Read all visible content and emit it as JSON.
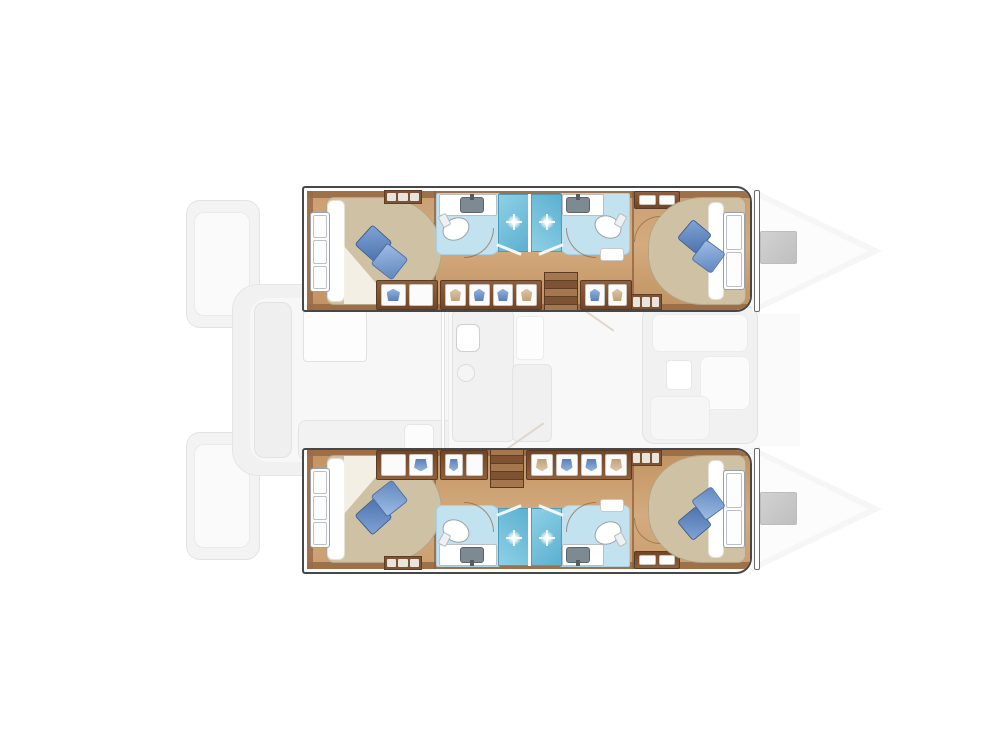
{
  "canvas": {
    "w": 1007,
    "h": 755,
    "bg": "#ffffff"
  },
  "palette": {
    "wood_floor": "#c99f72",
    "wood_dark_trim": "#9a6b45",
    "cabinet_brown": "#7c5335",
    "bed_beige": "#cfc1a3",
    "pillow_blue_dark": "#4f74ad",
    "pillow_blue_light": "#9dbce4",
    "bathroom_floor_blue": "#c2e2f0",
    "shower_blue": "#5cb0d1",
    "fixture_white": "#ffffff",
    "sink_gray": "#7e8a91",
    "faded_deck_gray": "#f1f1f1",
    "bow_hatch_gray": "#cacaca",
    "hull_outline": "#474747"
  },
  "hull_geometry": {
    "x": 302,
    "w": 450,
    "h": 126
  },
  "underlay": [
    {
      "name": "stern-platform-port",
      "x": 186,
      "y": 200,
      "w": 74,
      "h": 128,
      "bg": "#f3f3f3",
      "bd": "#e3e3e3",
      "r": "14px"
    },
    {
      "name": "stern-platform-port-step",
      "x": 194,
      "y": 212,
      "w": 56,
      "h": 104,
      "bg": "#fafafa",
      "bd": "#eaeaea",
      "r": "10px"
    },
    {
      "name": "stern-platform-starboard",
      "x": 186,
      "y": 432,
      "w": 74,
      "h": 128,
      "bg": "#f3f3f3",
      "bd": "#e3e3e3",
      "r": "14px"
    },
    {
      "name": "stern-platform-starboard-step",
      "x": 194,
      "y": 444,
      "w": 56,
      "h": 104,
      "bg": "#fafafa",
      "bd": "#eaeaea",
      "r": "10px"
    },
    {
      "name": "transom-steps-upper",
      "x": 250,
      "y": 332,
      "w": 24,
      "h": 22,
      "bg": "#f0f0f0",
      "bd": "#e4e4e4",
      "r": "4px"
    },
    {
      "name": "transom-steps-lower",
      "x": 250,
      "y": 404,
      "w": 24,
      "h": 22,
      "bg": "#f0f0f0",
      "bd": "#e4e4e4",
      "r": "4px"
    },
    {
      "name": "aft-cockpit-deck",
      "x": 232,
      "y": 284,
      "w": 244,
      "h": 192,
      "bg": "#f1f1f1",
      "bd": "#e5e5e5",
      "r": "26px"
    },
    {
      "name": "aft-cockpit-floor",
      "x": 250,
      "y": 298,
      "w": 212,
      "h": 164,
      "bg": "#f7f7f7",
      "r": "18px"
    },
    {
      "name": "cockpit-bench-left",
      "x": 254,
      "y": 302,
      "w": 38,
      "h": 156,
      "bg": "#efefef",
      "bd": "#e2e2e2",
      "r": "10px"
    },
    {
      "name": "cockpit-table",
      "x": 303,
      "y": 310,
      "w": 64,
      "h": 52,
      "bg": "#fdfdfd",
      "bd": "#e1e1e1",
      "r": "4px"
    },
    {
      "name": "cockpit-aft-seat",
      "x": 298,
      "y": 420,
      "w": 164,
      "h": 40,
      "bg": "#f2f2f2",
      "bd": "#e4e4e4",
      "r": "8px"
    },
    {
      "name": "cockpit-side-seat",
      "x": 404,
      "y": 424,
      "w": 30,
      "h": 32,
      "bg": "#fcfcfc",
      "bd": "#e6e6e6",
      "r": "6px"
    },
    {
      "name": "salon-deck",
      "x": 448,
      "y": 306,
      "w": 312,
      "h": 148,
      "bg": "#f8f8f8",
      "bd": "#ececec",
      "r": "8px"
    },
    {
      "name": "foredeck",
      "x": 754,
      "y": 314,
      "w": 46,
      "h": 132,
      "bg": "#fafafa"
    },
    {
      "name": "salon-door-track",
      "x": 441,
      "y": 304,
      "w": 4,
      "h": 152,
      "bg": "#ffffff",
      "bd": "#e0e0e0"
    },
    {
      "name": "galley-counter",
      "x": 452,
      "y": 310,
      "w": 62,
      "h": 132,
      "bg": "#f1f1f1",
      "bd": "#e3e3e3",
      "r": "6px"
    },
    {
      "name": "galley-appliance",
      "x": 456,
      "y": 324,
      "w": 24,
      "h": 28,
      "bg": "#ffffff",
      "bd": "#cfcfcf",
      "r": "6px"
    },
    {
      "name": "galley-sink-circle",
      "t": "ellipse",
      "x": 457,
      "y": 364,
      "w": 18,
      "h": 18,
      "bg": "#f5f5f5",
      "bd": "#dcdcdc"
    },
    {
      "name": "salon-island-top",
      "x": 516,
      "y": 316,
      "w": 28,
      "h": 44,
      "bg": "#fdfdfd",
      "bd": "#ececec",
      "r": "4px"
    },
    {
      "name": "salon-island",
      "x": 512,
      "y": 364,
      "w": 40,
      "h": 78,
      "bg": "#f0f0f0",
      "bd": "#e3e3e3",
      "r": "6px"
    },
    {
      "name": "hull-stair-rail-port",
      "x": 570,
      "y": 316,
      "w": 48,
      "h": 2,
      "bg": "#ded3c8",
      "rot": 35,
      "op": 0.9
    },
    {
      "name": "hull-stair-rail-starboard",
      "x": 500,
      "y": 436,
      "w": 48,
      "h": 2,
      "bg": "#ded3c8",
      "rot": -35,
      "op": 0.9
    },
    {
      "name": "salon-sofa-base",
      "x": 642,
      "y": 306,
      "w": 116,
      "h": 138,
      "bg": "#f1f1f1",
      "bd": "#e2e2e2",
      "r": "12px"
    },
    {
      "name": "salon-sofa-seat-fwd",
      "x": 652,
      "y": 314,
      "w": 96,
      "h": 38,
      "bg": "#fafafa",
      "bd": "#ececec",
      "r": "8px"
    },
    {
      "name": "salon-sofa-chaise",
      "x": 700,
      "y": 356,
      "w": 50,
      "h": 54,
      "bg": "#fbfbfb",
      "bd": "#ececec",
      "r": "8px"
    },
    {
      "name": "salon-sofa-seat-aft",
      "x": 650,
      "y": 396,
      "w": 60,
      "h": 44,
      "bg": "#f6f6f6",
      "bd": "#ececec",
      "r": "8px"
    },
    {
      "name": "salon-coffee-table",
      "x": 666,
      "y": 360,
      "w": 26,
      "h": 30,
      "bg": "#ffffff",
      "bd": "#e6e6e6",
      "r": "4px"
    },
    {
      "name": "bow-deck-port",
      "t": "tri",
      "x": 752,
      "y": 188,
      "w": 130,
      "h": 126,
      "bg": "#f6f6f6",
      "clip": "polygon(0 0,100% 50%,0 100%)"
    },
    {
      "name": "bow-deck-port-inner",
      "t": "tri",
      "x": 756,
      "y": 196,
      "w": 112,
      "h": 110,
      "bg": "#fcfcfc",
      "clip": "polygon(0 0,100% 50%,0 100%)"
    },
    {
      "name": "bow-hatch-port",
      "x": 760,
      "y": 231,
      "w": 37,
      "h": 33,
      "bg": "linear-gradient(135deg,#d2d2d2,#bfbfbf)",
      "bd": "#bdbdbd",
      "r": "2px"
    },
    {
      "name": "bow-deck-starboard",
      "t": "tri",
      "x": 752,
      "y": 446,
      "w": 130,
      "h": 126,
      "bg": "#f6f6f6",
      "clip": "polygon(0 0,100% 50%,0 100%)"
    },
    {
      "name": "bow-deck-starboard-inner",
      "t": "tri",
      "x": 756,
      "y": 454,
      "w": 112,
      "h": 110,
      "bg": "#fcfcfc",
      "clip": "polygon(0 0,100% 50%,0 100%)"
    },
    {
      "name": "bow-hatch-starboard",
      "x": 760,
      "y": 492,
      "w": 37,
      "h": 33,
      "bg": "linear-gradient(135deg,#d2d2d2,#bfbfbf)",
      "bd": "#bdbdbd",
      "r": "2px"
    }
  ],
  "hull_items": [
    {
      "name": "cabin-sole",
      "x": 3,
      "y": 3,
      "w": 444,
      "h": 120,
      "bg": "linear-gradient(180deg,#c99f72,#d4ab7e 45%,#c09160)",
      "r": "2px 12px 12px 2px"
    },
    {
      "name": "joinery-trim-top",
      "x": 3,
      "y": 3,
      "w": 444,
      "h": 7,
      "bg": "#9a6b45",
      "op": 0.9
    },
    {
      "name": "joinery-trim-bottom",
      "x": 3,
      "y": 116,
      "w": 444,
      "h": 7,
      "bg": "#9a6b45",
      "op": 0.9
    },
    {
      "name": "aft-bulkhead-trim",
      "x": 3,
      "y": 3,
      "w": 6,
      "h": 120,
      "bg": "#9a6b45",
      "op": 0.85
    },
    {
      "name": "bulkhead-aft-bathroom",
      "x": 130,
      "y": 3,
      "w": 2,
      "h": 120,
      "bg": "#8a5c3a",
      "op": 0.7
    },
    {
      "name": "bulkhead-fwd-cabin",
      "x": 328,
      "y": 3,
      "w": 2,
      "h": 120,
      "bg": "#8a5c3a",
      "op": 0.7
    },
    {
      "name": "aft-cabin-bed",
      "x": 22,
      "y": 9,
      "w": 116,
      "h": 108,
      "bg": "#cfc1a3",
      "bd": "#b4a485",
      "r": "8px 58px 58px 8px / 8px 54px 54px 8px"
    },
    {
      "name": "aft-bed-sheet",
      "x": 23,
      "y": 12,
      "w": 18,
      "h": 102,
      "bg": "#ffffff",
      "bd": "#e4e0d6",
      "r": "6px"
    },
    {
      "name": "aft-bed-sheet-fold",
      "t": "tri",
      "x": 40,
      "y": 58,
      "w": 50,
      "h": 58,
      "bg": "#f4f1e8",
      "clip": "polygon(0 0,100% 100%,0 100%)",
      "op": 0.95
    },
    {
      "name": "aft-berth-window",
      "t": "panes",
      "x": 6,
      "y": 24,
      "w": 20,
      "h": 80,
      "panes": 3
    },
    {
      "name": "aft-pillow-1",
      "x": 56,
      "y": 42,
      "w": 27,
      "h": 27,
      "bg": "linear-gradient(135deg,#7fa3d6,#4f74ad)",
      "bd": "#3d5f95",
      "r": "3px",
      "rot": 42
    },
    {
      "name": "aft-pillow-2",
      "x": 72,
      "y": 60,
      "w": 27,
      "h": 27,
      "bg": "linear-gradient(135deg,#9dbce4,#6288c0)",
      "bd": "#4d6fa5",
      "r": "3px",
      "rot": 38
    },
    {
      "name": "aft-locker-louver",
      "t": "louver",
      "x": 80,
      "y": 2,
      "w": 38,
      "h": 14,
      "bars": 3
    },
    {
      "name": "bathroom-floor-aft",
      "x": 132,
      "y": 5,
      "w": 64,
      "h": 62,
      "bg": "#c2e2f0",
      "bd": "#a8cfe2",
      "r": "2px 2px 10px 6px"
    },
    {
      "name": "bathroom-floor-fwd",
      "x": 256,
      "y": 5,
      "w": 70,
      "h": 62,
      "bg": "#c2e2f0",
      "bd": "#a8cfe2",
      "r": "2px 2px 6px 10px"
    },
    {
      "name": "shower-stall-aft",
      "x": 194,
      "y": 6,
      "w": 31,
      "h": 58,
      "bg": "linear-gradient(135deg,#8ed0e6,#5cb0d1)",
      "bd": "#4d9bba"
    },
    {
      "name": "shower-stall-fwd",
      "x": 227,
      "y": 6,
      "w": 31,
      "h": 58,
      "bg": "linear-gradient(45deg,#8ed0e6,#5cb0d1)",
      "bd": "#4d9bba"
    },
    {
      "name": "shower-divider-wall",
      "x": 224,
      "y": 6,
      "w": 3,
      "h": 58,
      "bg": "#ffffff"
    },
    {
      "name": "shower-head-sparkle-aft",
      "t": "sparkle",
      "x": 202,
      "y": 26,
      "w": 16,
      "h": 16
    },
    {
      "name": "shower-head-sparkle-fwd",
      "t": "sparkle",
      "x": 235,
      "y": 26,
      "w": 16,
      "h": 16
    },
    {
      "name": "vanity-counter-aft",
      "x": 135,
      "y": 6,
      "w": 58,
      "h": 22,
      "bg": "#ffffff",
      "bd": "#b9bfc3",
      "r": "2px"
    },
    {
      "name": "sink-basin-aft",
      "x": 156,
      "y": 9,
      "w": 24,
      "h": 16,
      "bg": "#7e8a91",
      "bd": "#5c656b",
      "r": "3px"
    },
    {
      "name": "faucet-aft",
      "x": 166,
      "y": 6,
      "w": 4,
      "h": 6,
      "bg": "#555b5f"
    },
    {
      "name": "toilet-aft",
      "t": "ellipse",
      "x": 138,
      "y": 30,
      "w": 28,
      "h": 22,
      "bg": "#ffffff",
      "bd": "#9aa2a8",
      "rot": -28
    },
    {
      "name": "toilet-aft-tank",
      "x": 136,
      "y": 26,
      "w": 9,
      "h": 13,
      "bg": "#eef0f1",
      "bd": "#b6bcc0",
      "r": "2px",
      "rot": -28
    },
    {
      "name": "vanity-counter-fwd",
      "x": 258,
      "y": 6,
      "w": 42,
      "h": 22,
      "bg": "#ffffff",
      "bd": "#b9bfc3",
      "r": "2px"
    },
    {
      "name": "sink-basin-fwd",
      "x": 262,
      "y": 9,
      "w": 24,
      "h": 16,
      "bg": "#7e8a91",
      "bd": "#5c656b",
      "r": "3px"
    },
    {
      "name": "faucet-fwd",
      "x": 272,
      "y": 6,
      "w": 4,
      "h": 6,
      "bg": "#555b5f"
    },
    {
      "name": "toilet-fwd",
      "t": "ellipse",
      "x": 290,
      "y": 28,
      "w": 28,
      "h": 22,
      "bg": "#ffffff",
      "bd": "#9aa2a8",
      "rot": 28
    },
    {
      "name": "toilet-fwd-tank",
      "x": 312,
      "y": 26,
      "w": 9,
      "h": 13,
      "bg": "#eef0f1",
      "bd": "#b6bcc0",
      "r": "2px",
      "rot": 28
    },
    {
      "name": "door-swing-aft-bathroom",
      "t": "arc",
      "x": 160,
      "y": 40,
      "w": 30,
      "h": 30,
      "bd": "#8a5c3a",
      "dir": "br",
      "op": 0.65
    },
    {
      "name": "door-swing-fwd-bathroom",
      "t": "arc",
      "x": 262,
      "y": 40,
      "w": 30,
      "h": 30,
      "bd": "#8a5c3a",
      "dir": "bl",
      "op": 0.65
    },
    {
      "name": "shower-door-aft",
      "x": 192,
      "y": 60,
      "w": 26,
      "h": 3,
      "bg": "#ffffff",
      "rot": 22,
      "op": 0.9
    },
    {
      "name": "shower-door-fwd",
      "x": 234,
      "y": 60,
      "w": 26,
      "h": 3,
      "bg": "#ffffff",
      "rot": -22,
      "op": 0.9
    },
    {
      "name": "bathroom-cabinet-fwd",
      "x": 296,
      "y": 60,
      "w": 24,
      "h": 13,
      "bg": "#ffffff",
      "bd": "#c9c9c9",
      "r": "3px"
    },
    {
      "name": "fwd-wardrobe",
      "t": "cabinet",
      "x": 330,
      "y": 3,
      "w": 46,
      "h": 18,
      "glyphs": [
        "none",
        "none"
      ]
    },
    {
      "name": "fwd-cabin-bed",
      "x": 344,
      "y": 9,
      "w": 98,
      "h": 108,
      "bg": "#cfc1a3",
      "bd": "#b4a485",
      "r": "54px 8px 8px 54px / 50px 8px 8px 50px"
    },
    {
      "name": "fwd-bed-sheet",
      "x": 404,
      "y": 14,
      "w": 16,
      "h": 98,
      "bg": "#ffffff",
      "bd": "#e4e0d6",
      "r": "6px"
    },
    {
      "name": "fwd-berth-window",
      "t": "panes",
      "x": 419,
      "y": 24,
      "w": 22,
      "h": 78,
      "panes": 2
    },
    {
      "name": "fwd-pillow-1",
      "x": 378,
      "y": 36,
      "w": 25,
      "h": 25,
      "bg": "linear-gradient(135deg,#7fa3d6,#4f74ad)",
      "bd": "#3d5f95",
      "r": "3px",
      "rot": 40
    },
    {
      "name": "fwd-pillow-2",
      "x": 392,
      "y": 56,
      "w": 25,
      "h": 25,
      "bg": "linear-gradient(135deg,#9dbce4,#6288c0)",
      "bd": "#4d6fa5",
      "r": "3px",
      "rot": 36
    },
    {
      "name": "fwd-locker-louver",
      "t": "louver",
      "x": 326,
      "y": 106,
      "w": 32,
      "h": 16,
      "bars": 3
    },
    {
      "name": "fwd-cabin-door-swing",
      "t": "arc",
      "x": 330,
      "y": 28,
      "w": 26,
      "h": 26,
      "bd": "#8a5c3a",
      "dir": "tl",
      "op": 0.6
    }
  ],
  "hulls": [
    {
      "name": "port-hull",
      "y": 186,
      "flip": false,
      "extras": [
        {
          "name": "wardrobe-a",
          "t": "cabinet",
          "x": 72,
          "y": 92,
          "w": 62,
          "h": 30,
          "glyphs": [
            "blue",
            "none"
          ]
        },
        {
          "name": "wardrobe-b",
          "t": "cabinet",
          "x": 136,
          "y": 92,
          "w": 102,
          "h": 30,
          "glyphs": [
            "tan",
            "blue",
            "blue",
            "tan"
          ]
        },
        {
          "name": "companionway-stairs",
          "t": "stairs",
          "x": 240,
          "y": 84,
          "w": 34,
          "h": 42,
          "steps": 5
        },
        {
          "name": "wardrobe-c",
          "t": "cabinet",
          "x": 276,
          "y": 92,
          "w": 52,
          "h": 30,
          "glyphs": [
            "blue",
            "tan"
          ]
        }
      ]
    },
    {
      "name": "starboard-hull",
      "y": 448,
      "flip": true,
      "extras": [
        {
          "name": "wardrobe-a",
          "t": "cabinet",
          "x": 72,
          "y": 92,
          "w": 62,
          "h": 30,
          "glyphs": [
            "none",
            "blue"
          ]
        },
        {
          "name": "wardrobe-b",
          "t": "cabinet",
          "x": 136,
          "y": 92,
          "w": 48,
          "h": 30,
          "glyphs": [
            "blue",
            "none"
          ]
        },
        {
          "name": "companionway-stairs",
          "t": "stairs",
          "x": 186,
          "y": 84,
          "w": 34,
          "h": 42,
          "steps": 5
        },
        {
          "name": "wardrobe-c",
          "t": "cabinet",
          "x": 222,
          "y": 92,
          "w": 106,
          "h": 30,
          "glyphs": [
            "tan",
            "blue",
            "blue",
            "tan"
          ]
        }
      ]
    }
  ],
  "overlay": [
    {
      "name": "bow-step-rail-port",
      "x": 754,
      "y": 190,
      "w": 6,
      "h": 122,
      "bg": "#ffffff",
      "bd": "#6b6b6b",
      "r": "2px",
      "z": 12
    },
    {
      "name": "bow-step-rail-starboard",
      "x": 754,
      "y": 448,
      "w": 6,
      "h": 122,
      "bg": "#ffffff",
      "bd": "#6b6b6b",
      "r": "2px",
      "z": 12
    }
  ]
}
